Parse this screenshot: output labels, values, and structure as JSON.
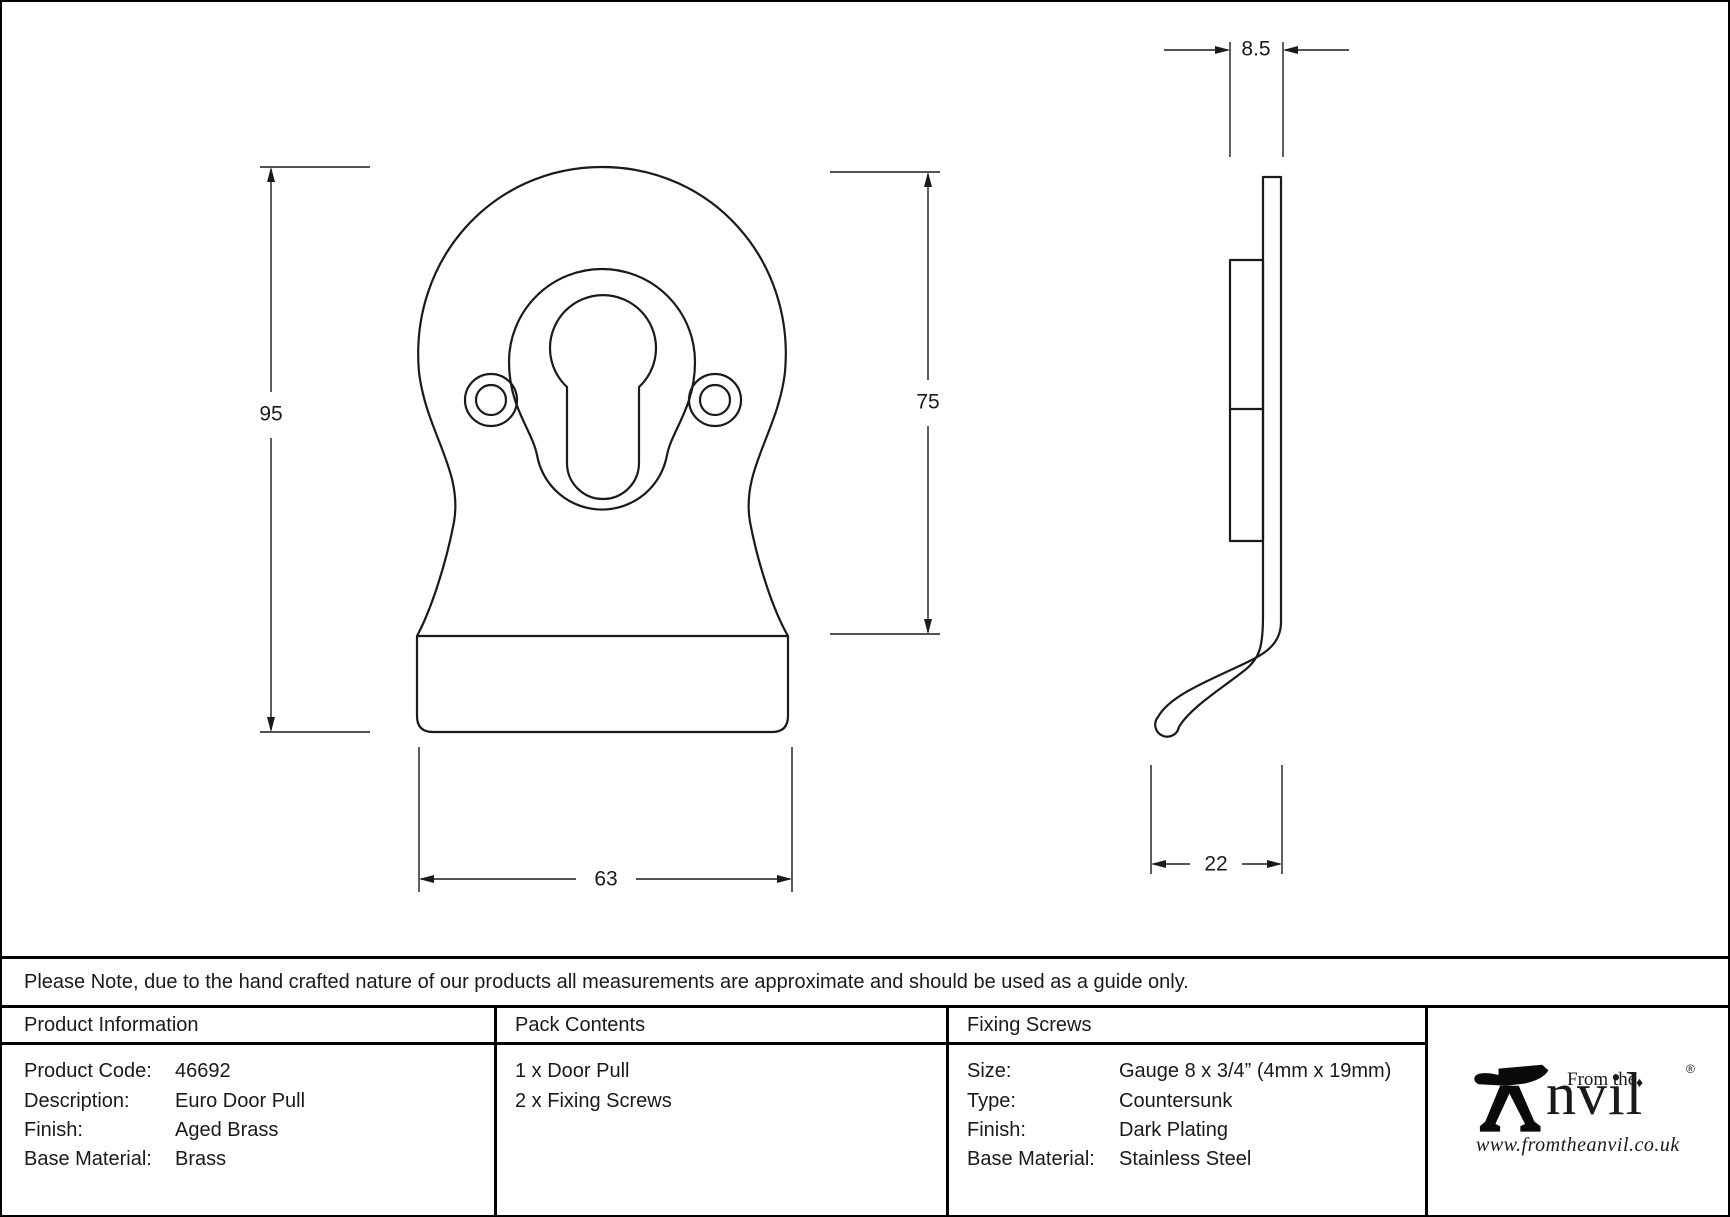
{
  "colors": {
    "ink": "#1a1a1a",
    "background": "#ffffff"
  },
  "drawing": {
    "front_view": {
      "overall_height": "95",
      "overall_width": "63",
      "plate_height": "75"
    },
    "side_view": {
      "projection_depth": "8.5",
      "hook_depth": "22"
    }
  },
  "note": "Please Note, due to the hand crafted nature of our products all measurements are approximate and should be used as a guide only.",
  "table": {
    "product_information": {
      "header": "Product Information",
      "rows": [
        {
          "label": "Product Code:",
          "value": "46692"
        },
        {
          "label": "Description:",
          "value": "Euro Door Pull"
        },
        {
          "label": "Finish:",
          "value": "Aged Brass"
        },
        {
          "label": "Base Material:",
          "value": "Brass"
        }
      ]
    },
    "pack_contents": {
      "header": "Pack Contents",
      "items": [
        "1 x Door Pull",
        "2 x Fixing Screws"
      ]
    },
    "fixing_screws": {
      "header": "Fixing Screws",
      "rows": [
        {
          "label": "Size:",
          "value": "Gauge 8 x 3/4” (4mm x 19mm)"
        },
        {
          "label": "Type:",
          "value": "Countersunk"
        },
        {
          "label": "Finish:",
          "value": "Dark Plating"
        },
        {
          "label": "Base Material:",
          "value": "Stainless Steel"
        }
      ]
    },
    "brand": {
      "prefix": "From the",
      "name": "nvil",
      "ornament": "♦",
      "registered": "®",
      "website": "www.fromtheanvil.co.uk"
    }
  }
}
